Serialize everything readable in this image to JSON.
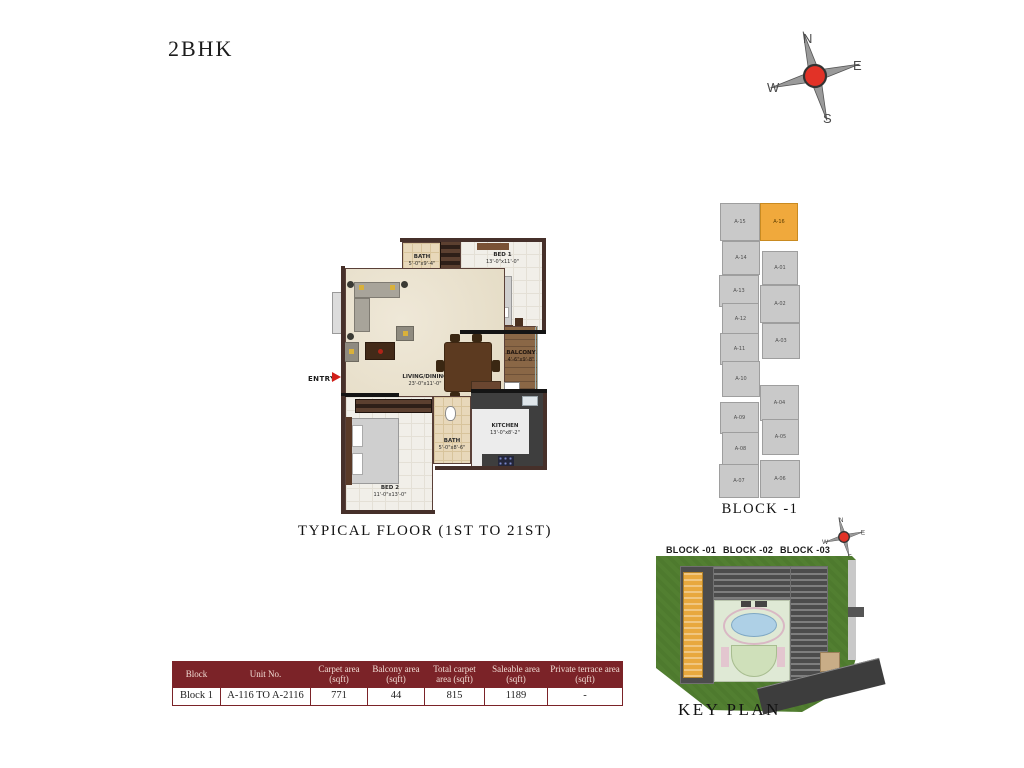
{
  "page": {
    "title": "2BHK"
  },
  "compass": {
    "n": "N",
    "e": "E",
    "w": "W",
    "s": "S"
  },
  "floor_plan": {
    "caption": "TYPICAL FLOOR (1ST TO 21ST)",
    "entry_label": "ENTRY",
    "foyer_note": "2 NOS",
    "rooms": {
      "bath1": {
        "name": "BATH",
        "dims": "5'-0\"x9'-4\""
      },
      "bed1": {
        "name": "BED 1",
        "dims": "13'-0\"x11'-0\""
      },
      "balcony": {
        "name": "BALCONY",
        "dims": "4'-6\"x9'-8\""
      },
      "living": {
        "name": "LIVING/DINING",
        "dims": "23'-0\"x11'-0\""
      },
      "bed2": {
        "name": "BED 2",
        "dims": "11'-0\"x13'-0\""
      },
      "bath2": {
        "name": "BATH",
        "dims": "5'-0\"x8'-6\""
      },
      "kitchen": {
        "name": "KITCHEN",
        "dims": "13'-0\"x8'-2\""
      }
    }
  },
  "tower": {
    "caption": "BLOCK -1",
    "left_units": [
      {
        "label": "A-15"
      },
      {
        "label": "A-14"
      },
      {
        "label": "A-13"
      },
      {
        "label": "A-12"
      },
      {
        "label": "A-11"
      },
      {
        "label": "A-10"
      },
      {
        "label": "A-09"
      },
      {
        "label": "A-08"
      },
      {
        "label": "A-07"
      }
    ],
    "right_units": [
      {
        "label": "A-16"
      },
      {
        "label": "A-01"
      },
      {
        "label": "A-02"
      },
      {
        "label": "A-03"
      },
      {
        "label": "A-04"
      },
      {
        "label": "A-05"
      },
      {
        "label": "A-06"
      }
    ]
  },
  "key_plan": {
    "caption": "KEY PLAN",
    "block_labels": [
      "BLOCK -01",
      "BLOCK -02",
      "BLOCK -03"
    ]
  },
  "table": {
    "headers": [
      "Block",
      "Unit No.",
      "Carpet area (sqft)",
      "Balcony area (sqft)",
      "Total carpet area (sqft)",
      "Saleable area (sqft)",
      "Private terrace area (sqft)"
    ],
    "row": [
      "Block 1",
      "A-116 TO A-2116",
      "771",
      "44",
      "815",
      "1189",
      "-"
    ]
  },
  "colors": {
    "accent_maroon": "#7b2328",
    "highlight_orange": "#f0a93c",
    "compass_red": "#e23227",
    "site_green": "#4e7a2e"
  }
}
